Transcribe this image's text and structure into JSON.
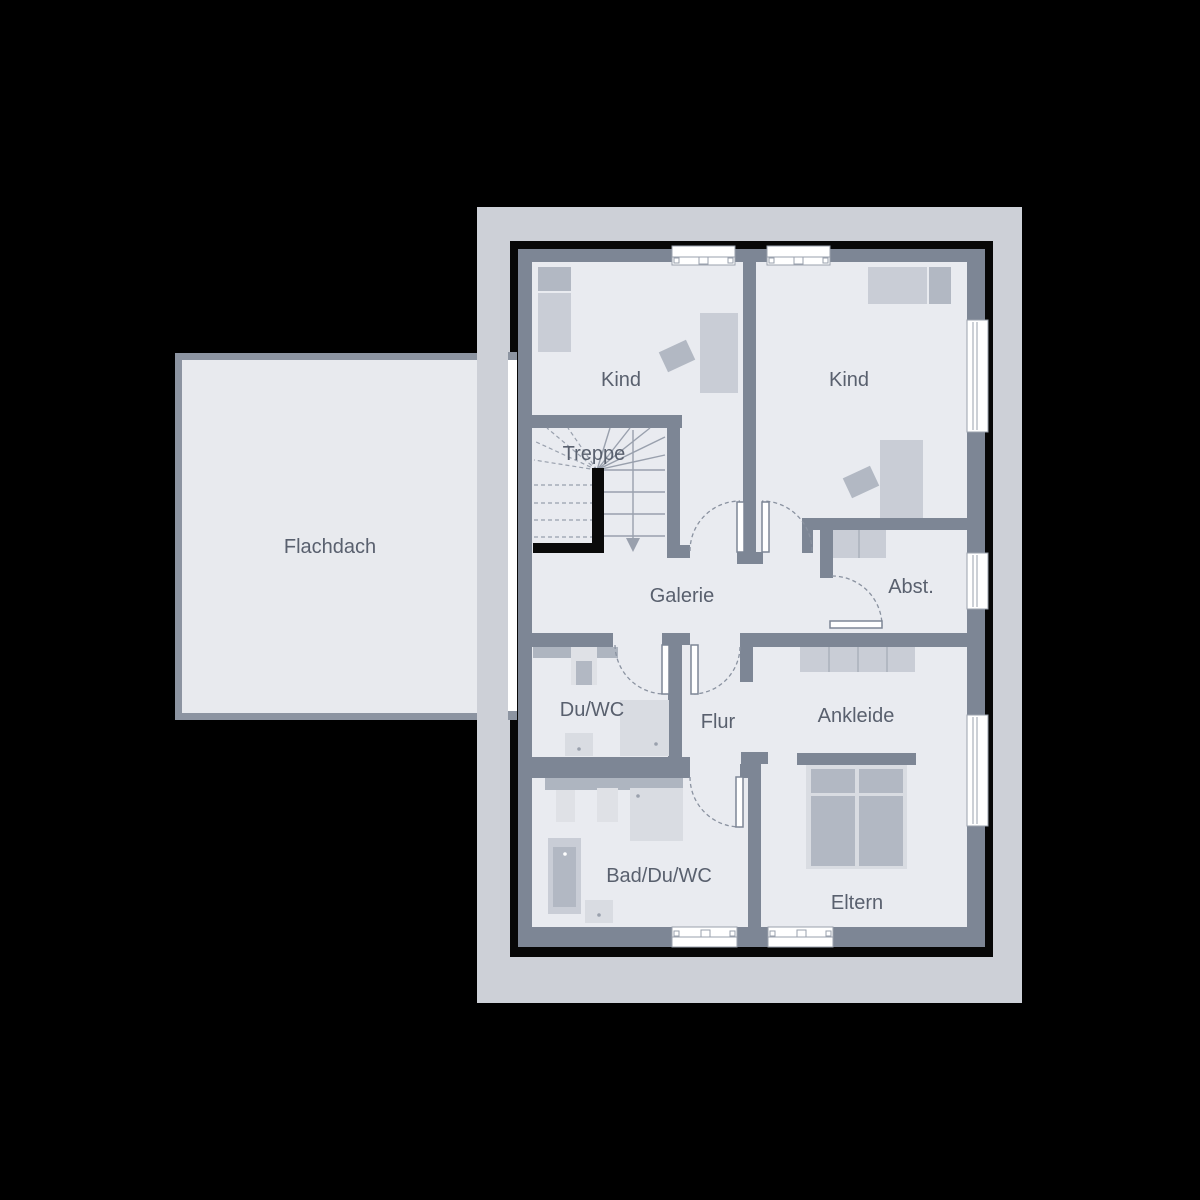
{
  "plan": {
    "type": "floor-plan",
    "rooms": {
      "flachdach": {
        "label": "Flachdach"
      },
      "kind_left": {
        "label": "Kind"
      },
      "kind_right": {
        "label": "Kind"
      },
      "treppe": {
        "label": "Treppe"
      },
      "galerie": {
        "label": "Galerie"
      },
      "abstellraum": {
        "label": "Abst."
      },
      "du_wc": {
        "label": "Du/WC"
      },
      "flur": {
        "label": "Flur"
      },
      "ankleide": {
        "label": "Ankleide"
      },
      "bad_du_wc": {
        "label": "Bad/Du/WC"
      },
      "eltern": {
        "label": "Eltern"
      }
    },
    "colors": {
      "background": "#000000",
      "surround": "#cdd0d7",
      "outline": "#0a0a0a",
      "wall": "#7d8695",
      "room_fill": "#e9ebf0",
      "flachdach_fill": "#e8eaee",
      "flachdach_border": "#8c94a1",
      "furniture_light": "#d9dce2",
      "furniture_medium": "#c9cdd6",
      "furniture_dark": "#b2b8c3",
      "counter": "#aeb5c0",
      "window": "#ffffff",
      "swing_line": "#8a92a0",
      "label_text": "#59606e"
    }
  }
}
